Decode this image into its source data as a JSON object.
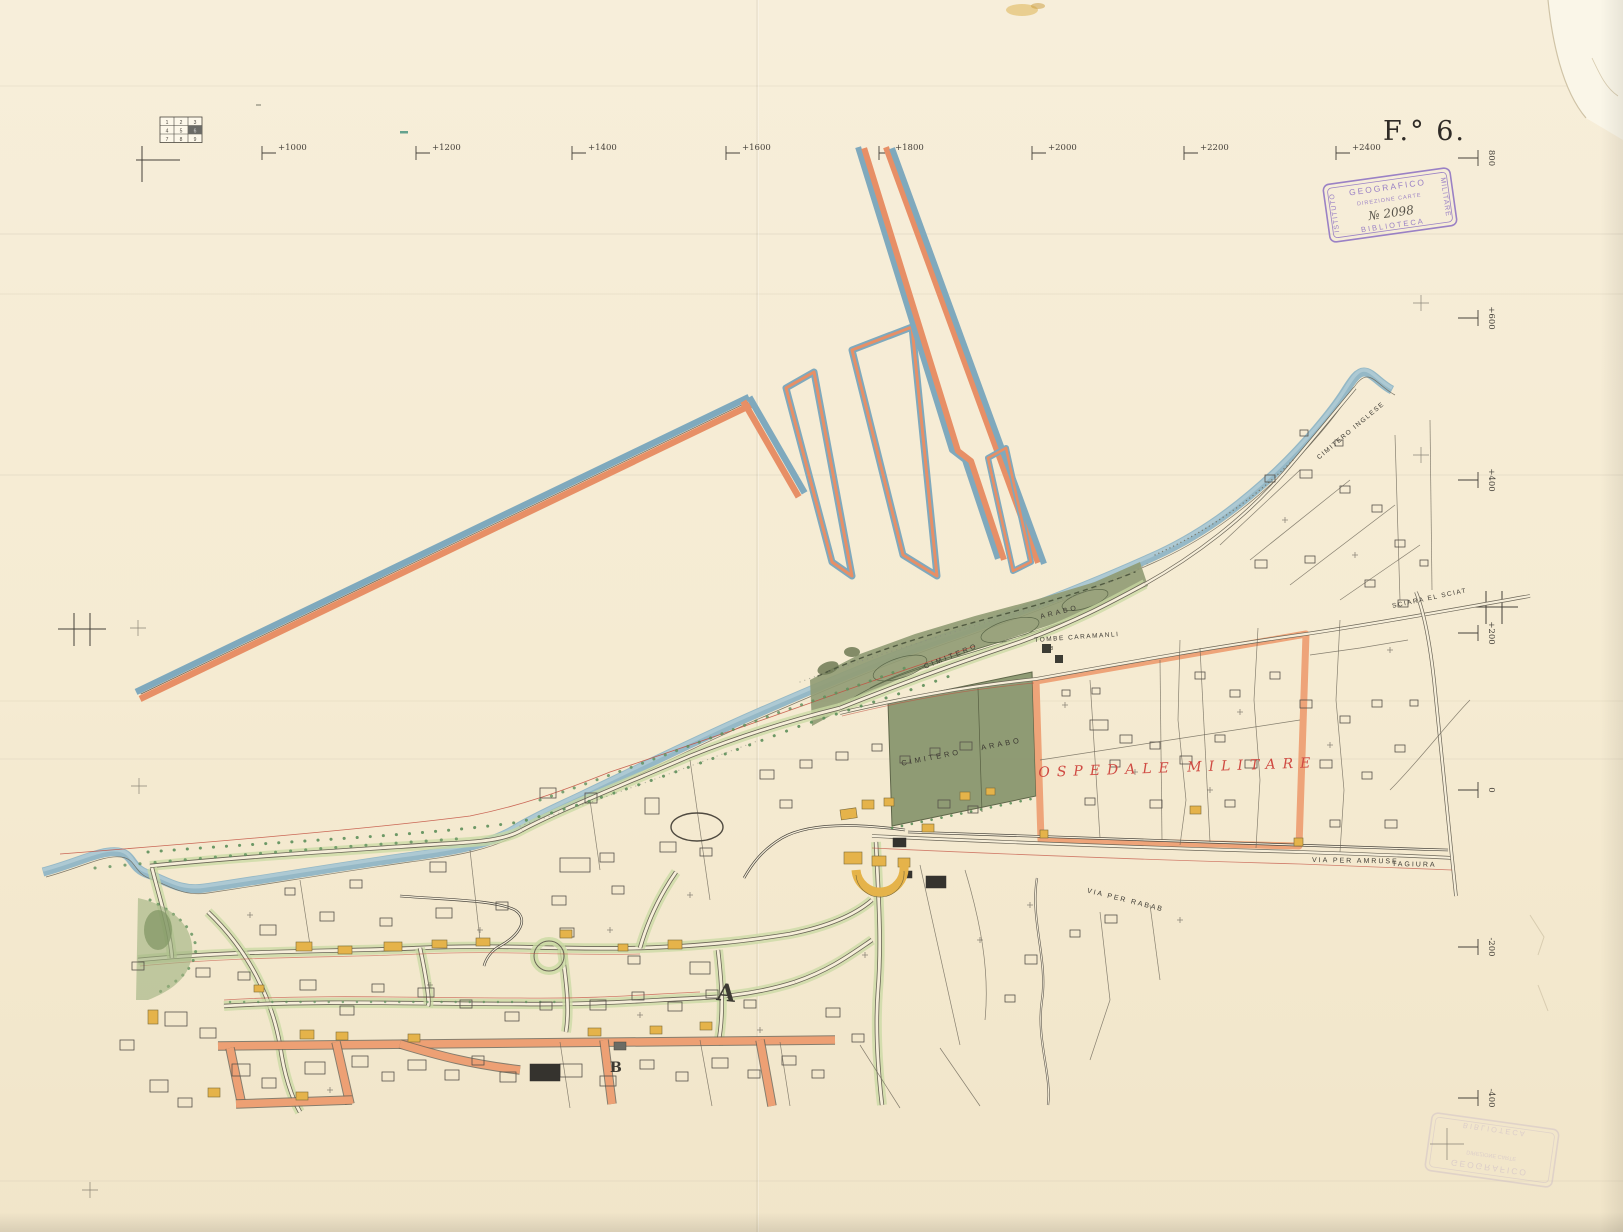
{
  "sheet": {
    "number_label": "F.° 6.",
    "index_grid": {
      "cells": [
        "1",
        "2",
        "3",
        "4",
        "5",
        "6",
        "7",
        "8",
        "9"
      ],
      "highlighted_cell": "6"
    },
    "top_coordinates": [
      "+1000",
      "+1200",
      "+1400",
      "+1600",
      "+1800",
      "+2000",
      "+2200",
      "+2400"
    ],
    "right_coordinates": [
      "800",
      "+600",
      "+400",
      "+200",
      "0",
      "-200",
      "-400"
    ]
  },
  "stamps": {
    "library_stamp": {
      "top": "GEOGRAFICO",
      "left": "ISTITUTO",
      "right": "MILITARE",
      "bottom": "BIBLIOTECA",
      "line1": "DIREZIONE CARTE",
      "line2": "№ 2098"
    }
  },
  "map_labels": {
    "ospedale_militare": "OSPEDALE MILITARE",
    "cimitero_arabo_field": "CIMITERO ARABO",
    "cimitero_dune": "CIMITERO",
    "arabo_dune": "ARABO",
    "tombe_caramanli": "TOMBE CARAMANLI",
    "v18": "V. 18",
    "cimitero_inglese": "CIMITERO INGLESE",
    "via_per_amruse": "VIA PER AMRUSE",
    "tagiura": "TAGIURA",
    "via_per_rabab": "VIA PER RABAB",
    "sciara_el_sciat": "SCIARA EL SCIAT",
    "section_a": "A",
    "section_b": "B"
  },
  "colors": {
    "sea_blue": "#7fa9bd",
    "works_orange": "#e78f66",
    "compound_orange": "#eda074",
    "dune_green": "#919c75",
    "road_green": "#c9daa3",
    "building_yellow": "#e5b34a",
    "red_line": "#c24f40",
    "stamp_purple": "#8a6fc2",
    "paper": "#f5ecd5"
  }
}
